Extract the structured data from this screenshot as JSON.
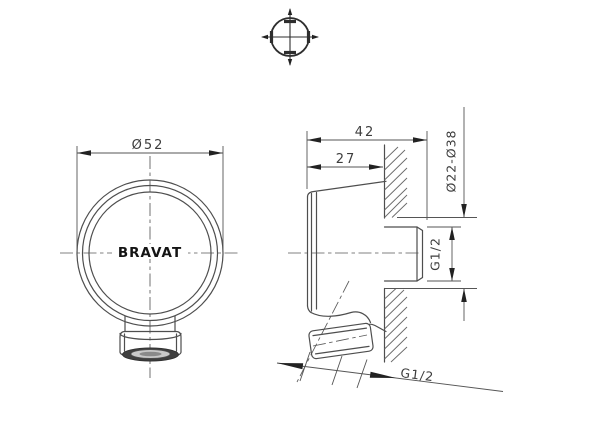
{
  "drawing": {
    "title_block": "none-visible",
    "projection_symbol": "centering-target-mark",
    "brand_logo": "BRAVAT",
    "front_view": {
      "diameter_dim": "Ø52"
    },
    "side_view": {
      "total_depth_dim": "42",
      "front_depth_dim": "27",
      "wall_hole_range_dim": "Ø22-Ø38",
      "inlet_thread_dim": "G1/2",
      "outlet_thread_dim": "G1/2"
    },
    "colors": {
      "line": "#4e4e4e",
      "dimension_text": "#3d3d3d",
      "logo": "#141414",
      "background": "#ffffff"
    }
  }
}
